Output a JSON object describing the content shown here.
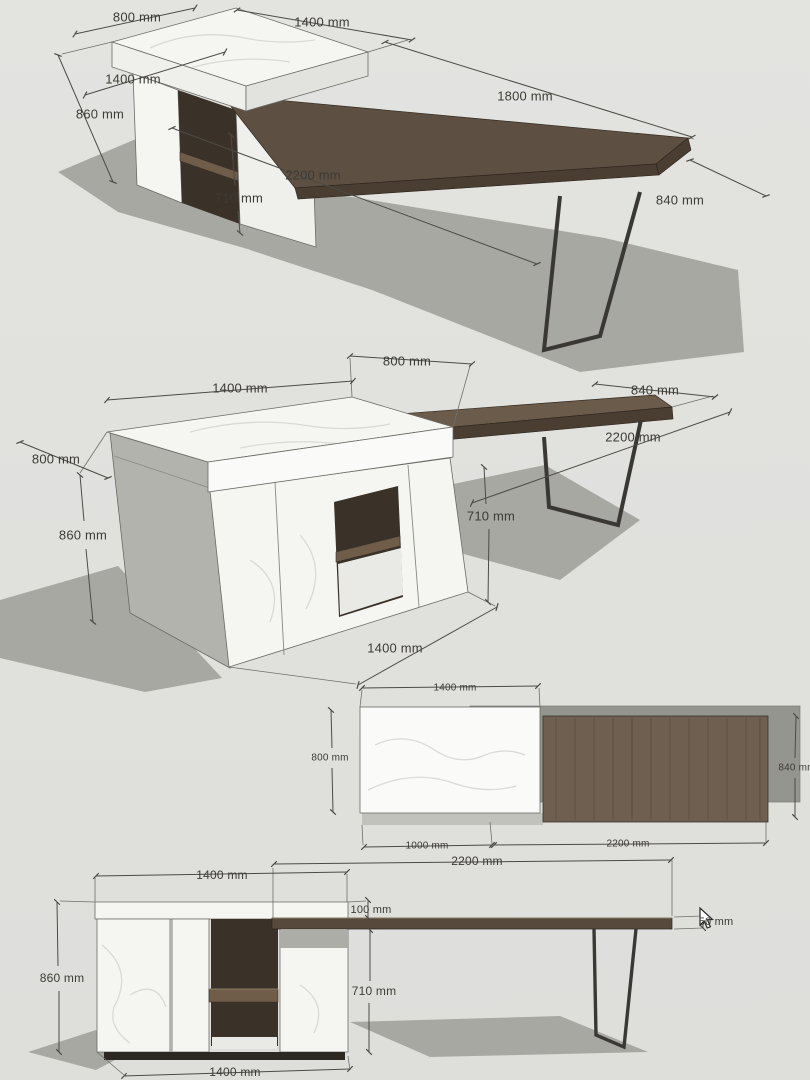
{
  "colors": {
    "bg": "#e3e3e0",
    "shadow": "#a8a8a3",
    "marble": "#f5f5f2",
    "marble_bright": "#fafaf8",
    "marble_dim": "#efefeb",
    "marble_dim2": "#e2e2de",
    "gray_face": "#b3b3ae",
    "gray_patch": "#adada8",
    "light_interior": "#e9e9e5",
    "wood": "#5d4f41",
    "wood2": "#6a5b4b",
    "wood_dark": "#4a3e33",
    "wood_plan": "#6e5f50",
    "wood_bar": "#574a3d",
    "wood_shelf": "#6f5c49",
    "dark_niche": "#3a3129",
    "plinth": "#2c2822",
    "metal": "#3a3835",
    "gray_plan": "#95958f",
    "gray_strip": "#c2c2bd",
    "dim_line": "#4c4b46",
    "ext_line": "#70706a",
    "text": "#3c3b35"
  },
  "views": {
    "iso_front": {
      "labels": {
        "depth_top": "800 mm",
        "width_top": "1400 mm",
        "width_front": "1400 mm",
        "height": "860 mm",
        "table_overhang": "1800 mm",
        "table_length": "2200 mm",
        "clearance_height": "710 mm",
        "table_depth": "840 mm"
      }
    },
    "iso_back": {
      "labels": {
        "width_top": "1400 mm",
        "depth_top": "800 mm",
        "depth_left": "800 mm",
        "height": "860 mm",
        "table_depth": "840 mm",
        "table_length": "2200 mm",
        "clearance_height": "710 mm",
        "width_bottom": "1400 mm"
      }
    },
    "plan": {
      "labels": {
        "cabinet_width": "1400 mm",
        "cabinet_depth": "800 mm",
        "table_depth": "840 mm",
        "table_inset": "1000 mm",
        "table_length": "2200 mm"
      }
    },
    "elevation": {
      "labels": {
        "table_length": "2200 mm",
        "cabinet_width_top": "1400 mm",
        "top_gap": "100 mm",
        "top_thickness": "50 mm",
        "cabinet_height": "860 mm",
        "clearance_height": "710 mm",
        "cabinet_width_bottom": "1400 mm"
      }
    }
  }
}
